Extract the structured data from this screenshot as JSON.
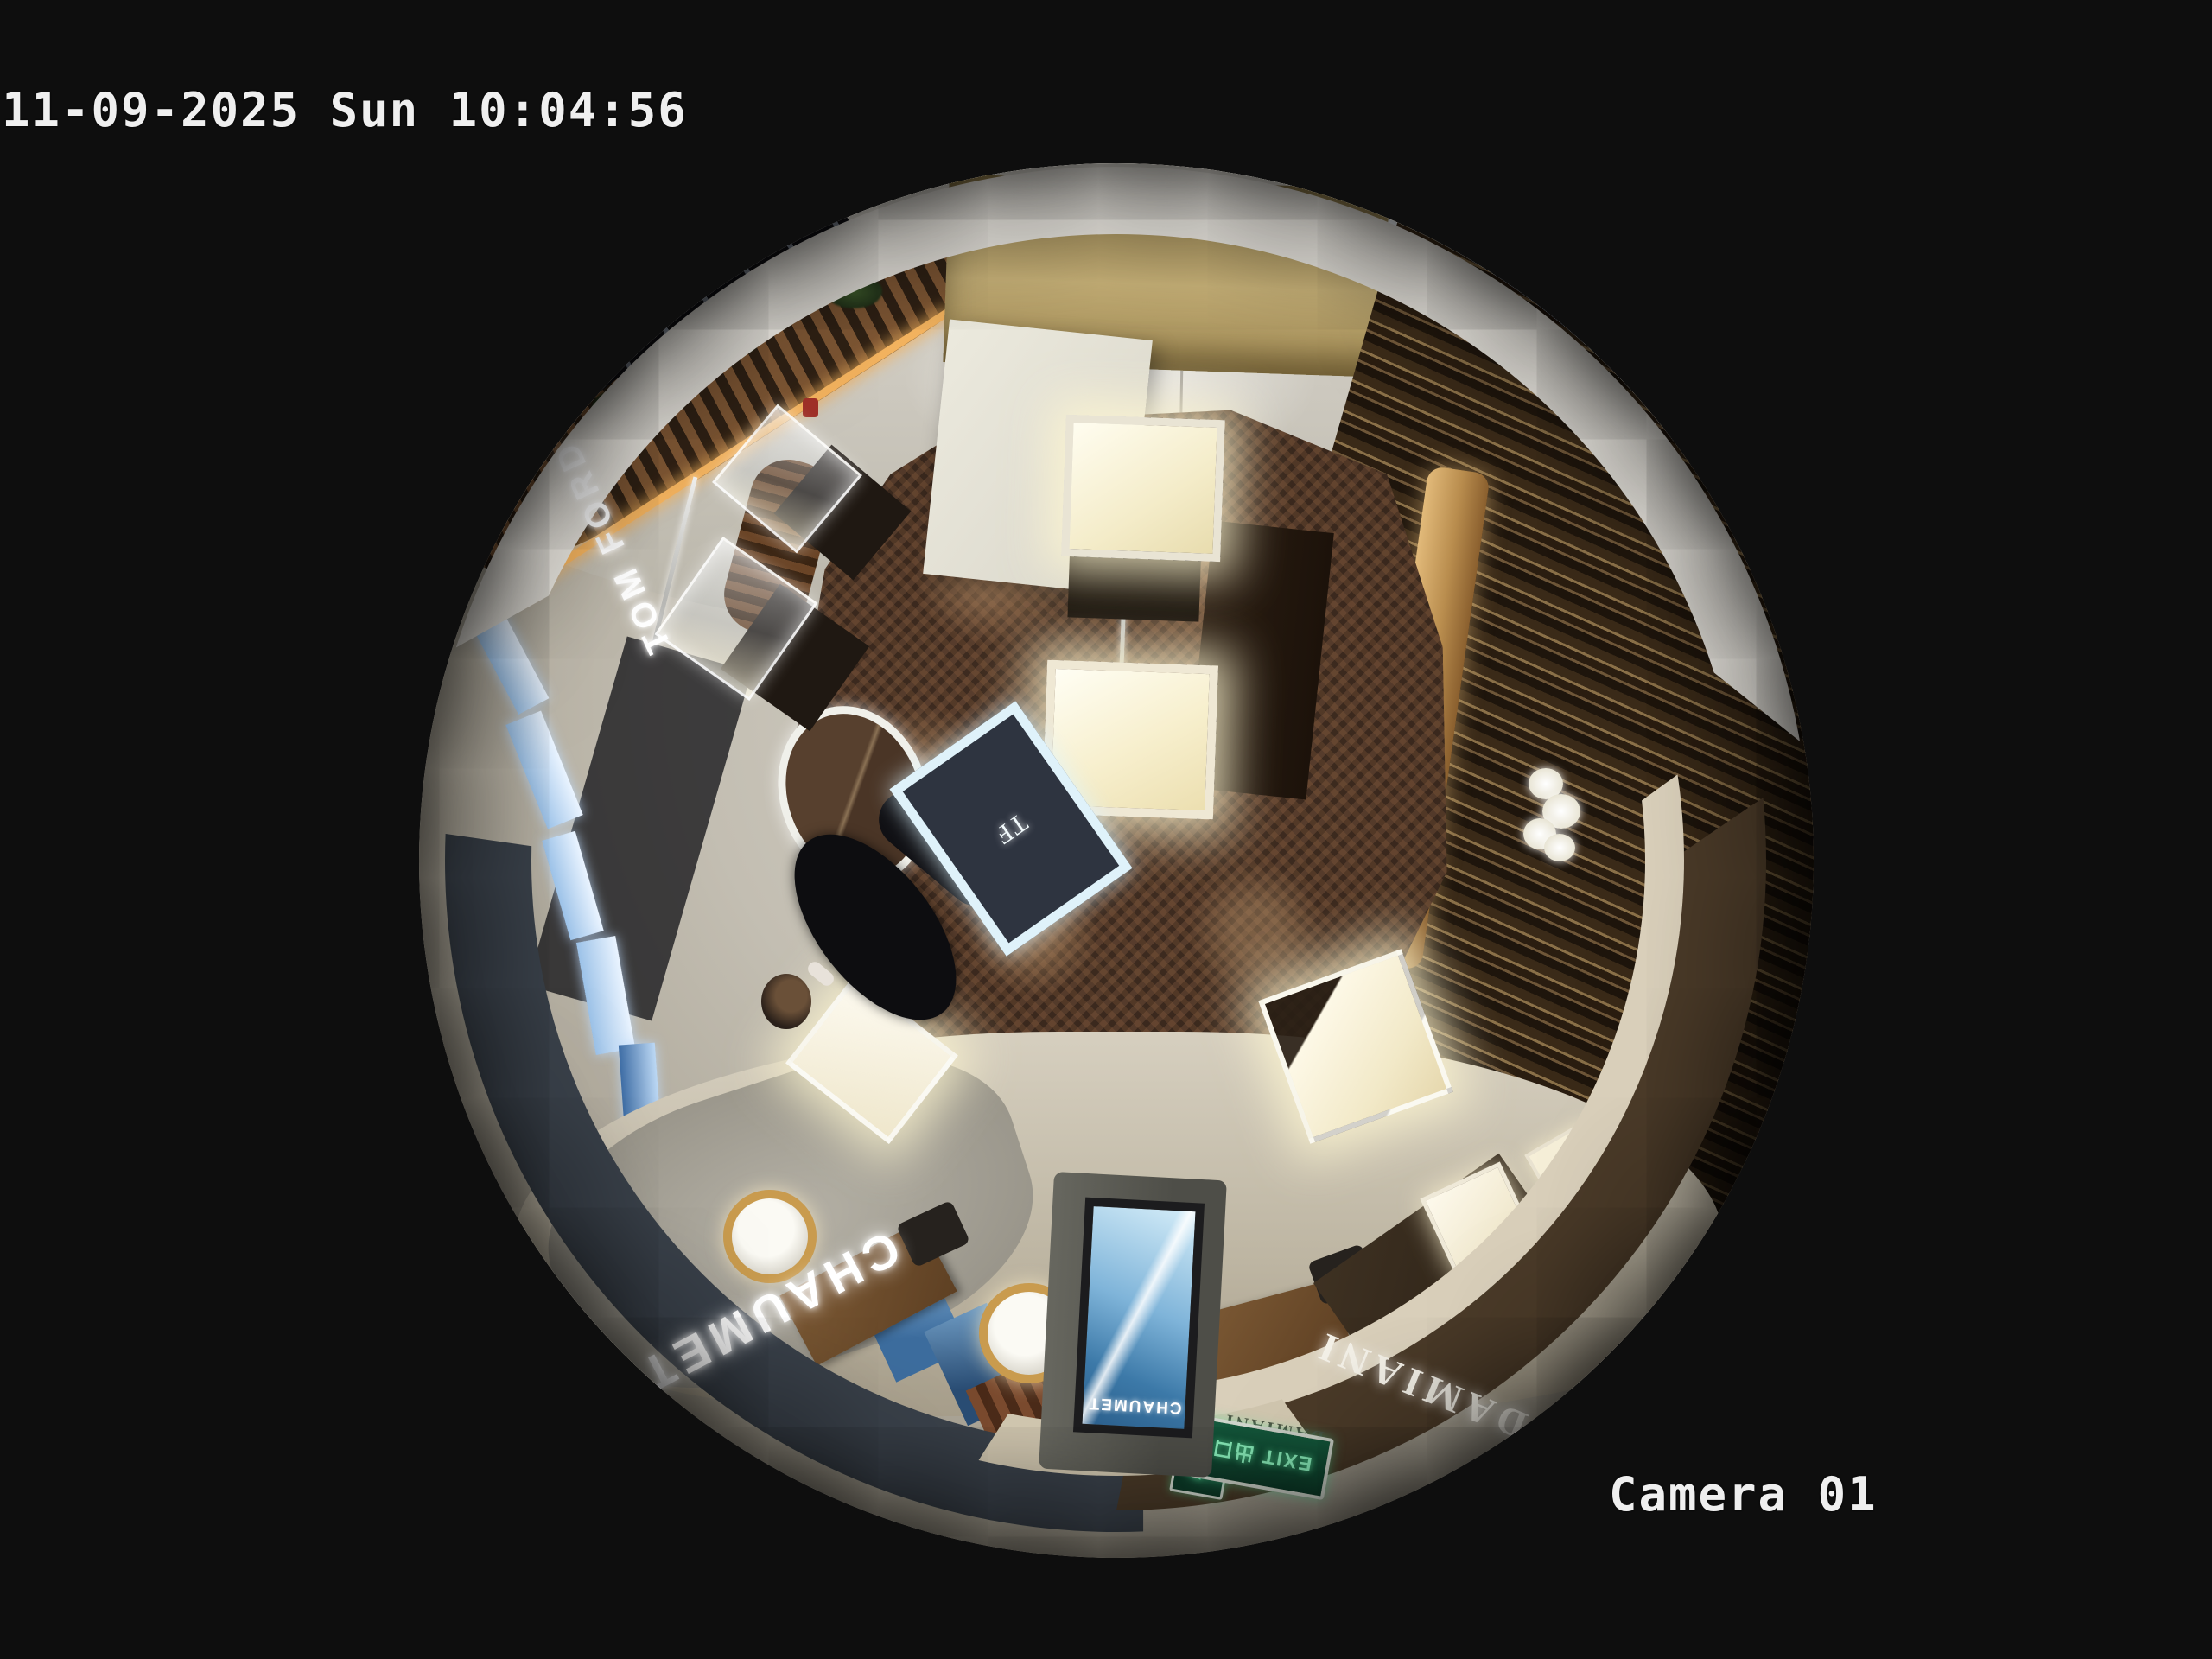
{
  "overlay": {
    "timestamp": "11-09-2025 Sun 10:04:56",
    "camera_label": "Camera 01",
    "text_color": "#efefef"
  },
  "signs": {
    "chaumet": "CHAUMET",
    "damiani": "DAMIANI",
    "damiani_small": "DAMIANI",
    "tom_ford": "TOM FORD",
    "tf_monogram": "TF",
    "exit": "EXIT 出口",
    "kiosk_brand": "CHAUMET"
  },
  "colors": {
    "background": "#0e0e0e",
    "corridor_floor": "#c6c2b8",
    "wood_floor": "#4a3324",
    "chaumet_fascia": "#394049",
    "damiani_fascia": "#4a3a28",
    "cream_fascia": "#d9cfba",
    "slat_wood": "#6e5638",
    "gold_trim": "#c99b4e",
    "screen_blue": "#7fb4d9",
    "exit_green": "#14593c",
    "case_glow": "#f7efcd"
  }
}
